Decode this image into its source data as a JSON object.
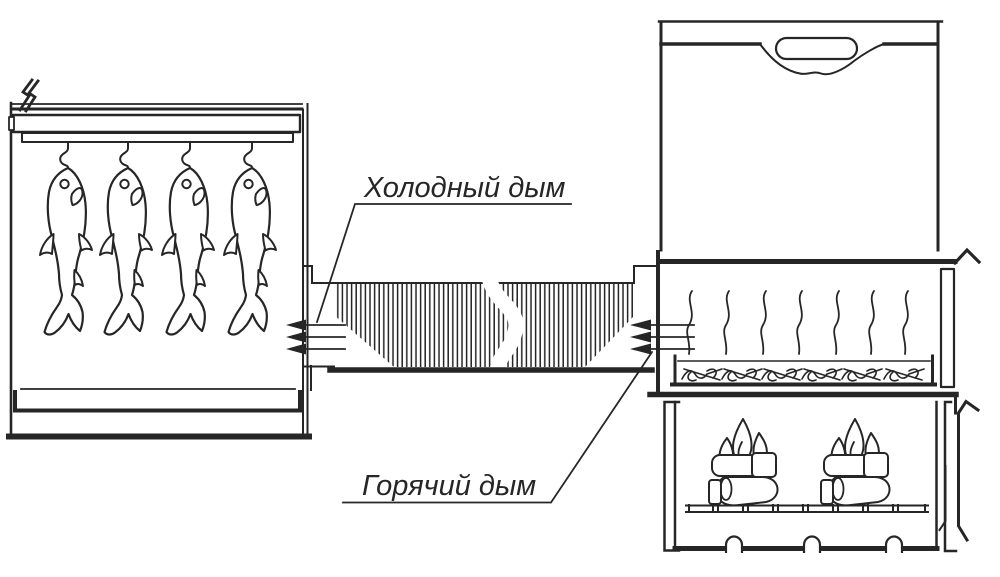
{
  "labels": {
    "cold_smoke": "Холодный дым",
    "hot_smoke": "Горячий дым"
  },
  "colors": {
    "line": "#262626",
    "background": "#ffffff"
  }
}
